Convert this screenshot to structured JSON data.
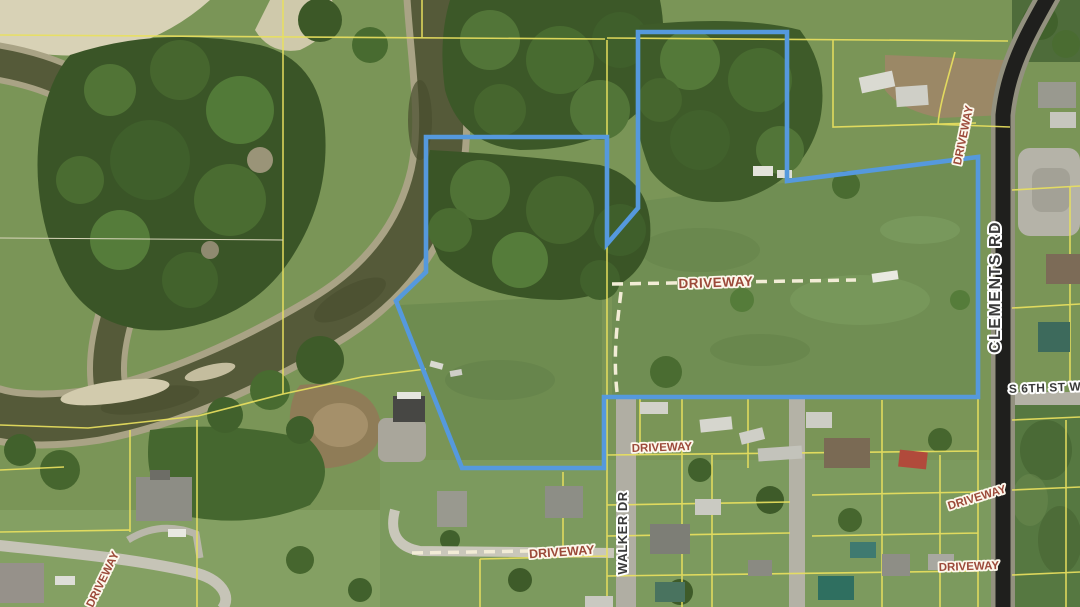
{
  "labels": {
    "clements_rd": "CLEMENTS RD",
    "walker_dr": "WALKER DR",
    "s_6th_st_w": "S 6TH ST W",
    "driveways": [
      "DRIVEWAY",
      "DRIVEWAY",
      "DRIVEWAY",
      "DRIVEWAY",
      "DRIVEWAY",
      "DRIVEWAY",
      "DRIVEWAY"
    ]
  },
  "colors": {
    "boundary_blue": "#5599dd",
    "parcel_yellow": "#e8e05e",
    "driveway_label_text": "#9c4a3a",
    "street_label_text": "#3a3a3a",
    "road_asphalt": "#1f1f1d",
    "water": "#555a39"
  }
}
